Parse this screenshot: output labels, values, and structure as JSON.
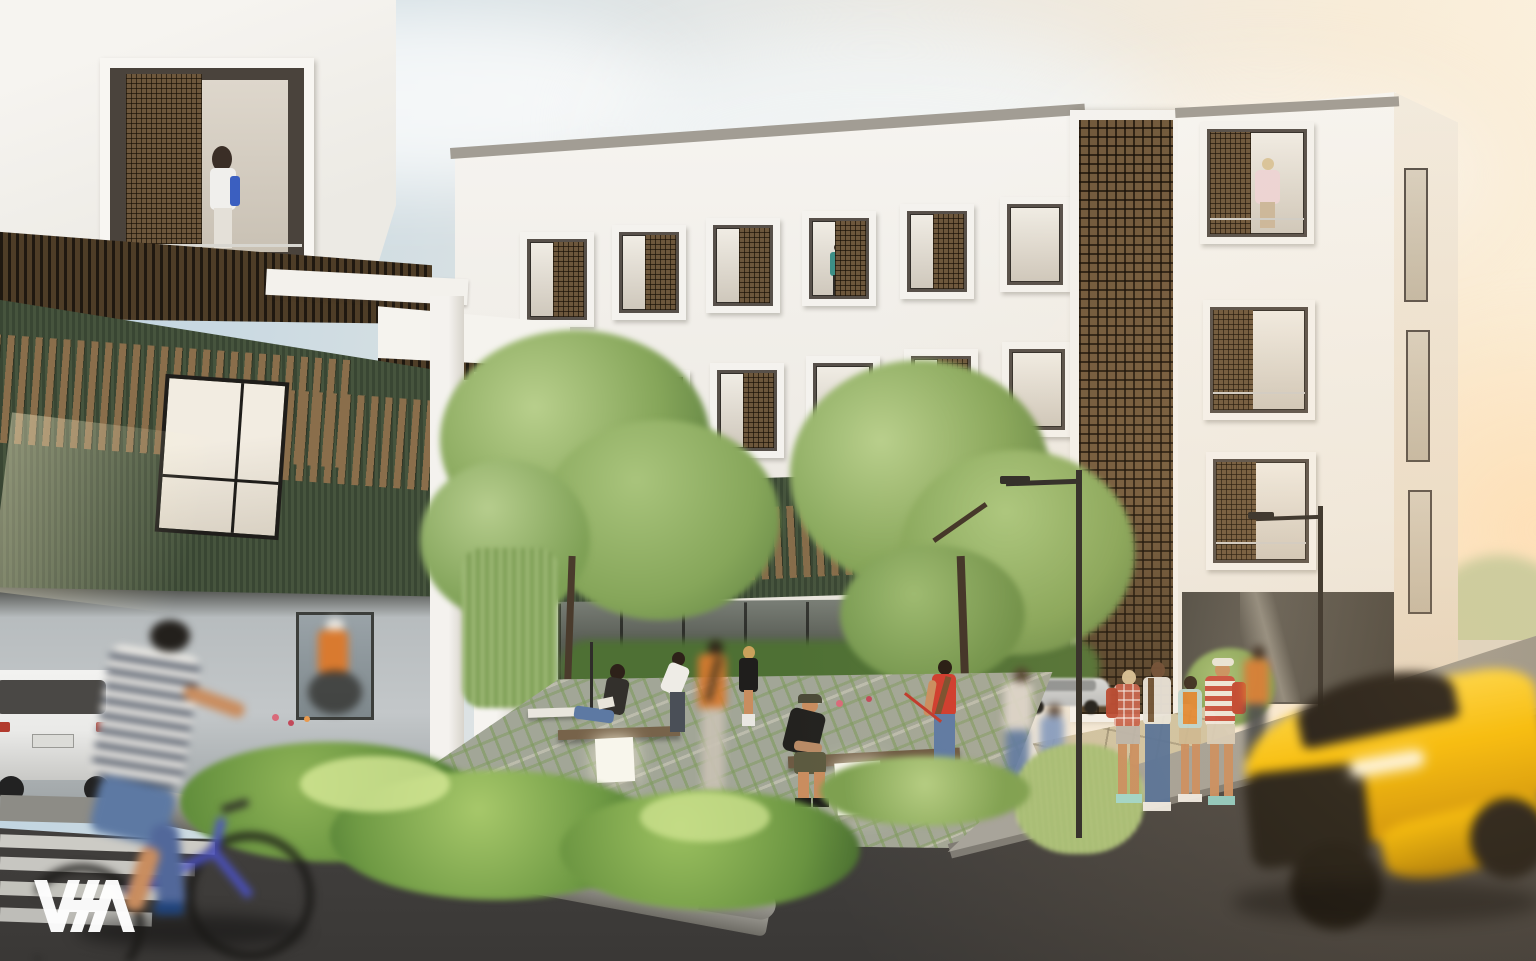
{
  "watermark": {
    "label": "VSA"
  },
  "palette": {
    "sky-top": "#b9d0e0",
    "sky-mid": "#e3e6e5",
    "sky-warm": "#f8ecd8",
    "sun-glow": "#ffd9a8",
    "cloud": "#f2f4f5",
    "facade-white": "#f4f2ee",
    "facade-shade": "#e6e2db",
    "parapet": "#a29d94",
    "frame-dark": "#332f2a",
    "glass-light": "#e9e4da",
    "glass-dark": "#6e675d",
    "siding": "#46543d",
    "siding2": "#394633",
    "wood": "#8a6e4b",
    "wood-dark": "#4e3d27",
    "lattice-brown": "#7b6345",
    "storefront": "#55584f",
    "tree": "#86a65a",
    "tree-dark": "#5d7f3f",
    "tree-light": "#b8cf8c",
    "plant": "#6f9a44",
    "plant-dark": "#3f6b2b",
    "paver": "#a2a697",
    "paver-joint": "#7e9a5d",
    "walkway": "#cfc3a3",
    "road": "#454341",
    "road-light": "#5a5856",
    "sidewalk": "#a09e96",
    "curb": "#c6c4bc",
    "crosswalk": "#dbdad4",
    "car-yellow": "#eebb16",
    "car-yellow-deep": "#c79208",
    "suv-white": "#eaeae8",
    "car-black": "#1e1d1b",
    "car-silver": "#b9bcbe",
    "red": "#cf3b2d",
    "denim": "#5d79a3",
    "orange": "#d97a2f",
    "skin": "#c98d5f",
    "glow-white": "#f8f6ec"
  },
  "scene": {
    "objects": [
      "white-apartment-building",
      "green-siding-wing",
      "brown-lattice-stair-tower",
      "framed-box-windows",
      "wood-slat-canopy",
      "porte-cochere-columns",
      "carport-with-white-suv",
      "courtyard-garden",
      "paver-plaza",
      "benches-with-light-cubes",
      "large-trees",
      "planting-beds",
      "granite-planter-curb",
      "crosswalk",
      "street",
      "sidewalk-corner",
      "street-lamps",
      "group-of-backpackers",
      "woman-with-dog",
      "seated-readers",
      "blurred-pedestrians",
      "blurred-cyclist",
      "yellow-sports-car-motion-blur",
      "parked-black-suv",
      "parked-silver-car",
      "balcony-figures",
      "vsa-logo"
    ]
  }
}
